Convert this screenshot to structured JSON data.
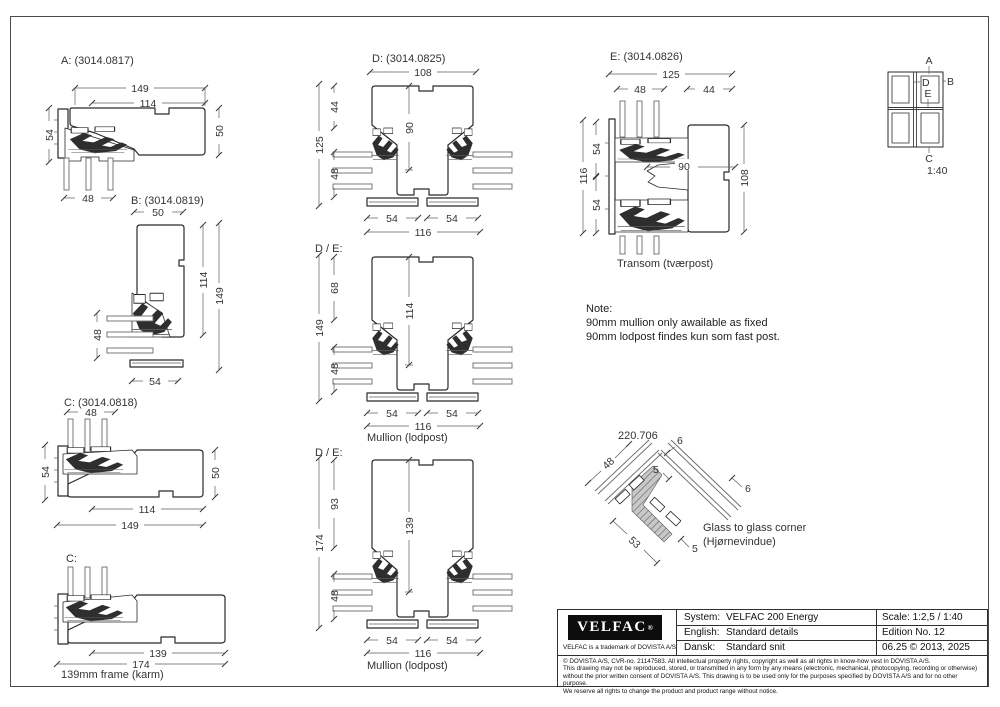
{
  "details": {
    "a": {
      "label": "A: (3014.0817)",
      "d149": "149",
      "d114": "114",
      "d54": "54",
      "d50": "50",
      "d48": "48"
    },
    "b": {
      "label": "B: (3014.0819)",
      "d50": "50",
      "d114": "114",
      "d149": "149",
      "d48": "48",
      "d54": "54"
    },
    "c": {
      "label": "C: (3014.0818)",
      "d48": "48",
      "d54": "54",
      "d50": "50",
      "d114": "114",
      "d149": "149"
    },
    "c2": {
      "label": "C:",
      "d139": "139",
      "d174": "174",
      "caption": "139mm frame (karm)"
    },
    "d": {
      "label": "D: (3014.0825)",
      "d108": "108",
      "d44": "44",
      "d90": "90",
      "d125": "125",
      "d48": "48",
      "d54l": "54",
      "d54r": "54",
      "d116": "116"
    },
    "de1": {
      "label": "D / E:",
      "d68": "68",
      "d114": "114",
      "d149": "149",
      "d48": "48",
      "d54l": "54",
      "d54r": "54",
      "d116": "116",
      "caption": "Mullion (lodpost)"
    },
    "de2": {
      "label": "D / E:",
      "d93": "93",
      "d139": "139",
      "d174": "174",
      "d48": "48",
      "d54l": "54",
      "d54r": "54",
      "d116": "116",
      "caption": "Mullion (lodpost)"
    },
    "e": {
      "label": "E: (3014.0826)",
      "d125": "125",
      "d48": "48",
      "d44": "44",
      "d54u": "54",
      "d116": "116",
      "d54l": "54",
      "d90": "90",
      "d108": "108",
      "caption": "Transom (tværpost)"
    },
    "corner": {
      "label": "220.706",
      "d6a": "6",
      "d6b": "6",
      "d5a": "5",
      "d5b": "5",
      "d48": "48",
      "d53": "53",
      "caption1": "Glass to glass corner",
      "caption2": "(Hjørnevindue)"
    }
  },
  "note": {
    "title": "Note:",
    "line1": "90mm mullion only awailable as fixed",
    "line2": "90mm lodpost findes kun som fast post."
  },
  "keyplan": {
    "a": "A",
    "b": "B",
    "c": "C",
    "d": "D",
    "e": "E",
    "scale": "1:40"
  },
  "titleblock": {
    "logo": "VELFAC",
    "logo_mark": "®",
    "trademark": "VELFAC is a trademark of DOVISTA A/S",
    "rows": [
      {
        "key": "System:",
        "value": "VELFAC 200 Energy"
      },
      {
        "key": "English:",
        "value": "Standard details"
      },
      {
        "key": "Dansk:",
        "value": "Standard snit"
      }
    ],
    "meta": [
      "Scale: 1:2,5  / 1:40",
      "Edition No. 12",
      "06.25 © 2013, 2025"
    ],
    "legal": [
      "© DOVISTA A/S, CVR-no. 21147583. All intellectual property rights, copyright as well as all rights in know-how vest in DOVISTA A/S.",
      "This drawing may not be reproduced, stored, or transmitted in any form by any means (electronic, mechanical, photocopying, recording or otherwise)",
      "without the prior written consent of DOVISTA A/S. This drawing is to be used only for the purposes specified by DOVISTA A/S and for no other purpose.",
      "We reserve all rights to change the product and product range without notice."
    ]
  }
}
